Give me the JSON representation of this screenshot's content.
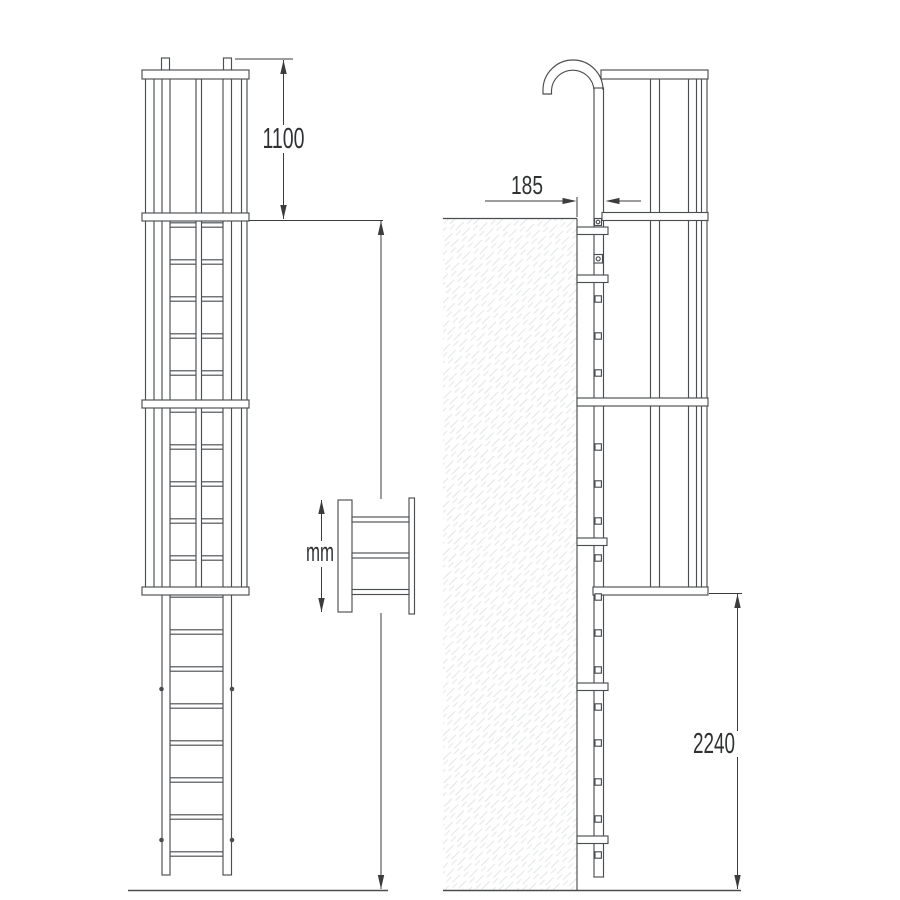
{
  "labels": {
    "cage_extension_height": "1100",
    "wall_distance": "185",
    "variable_height": "mm",
    "base_height": "2240"
  },
  "colors": {
    "line": "#4b4e50",
    "dim": "#3a3c3e",
    "text": "#2f3133",
    "hatch": "#d4d8da",
    "background": "#ffffff"
  }
}
